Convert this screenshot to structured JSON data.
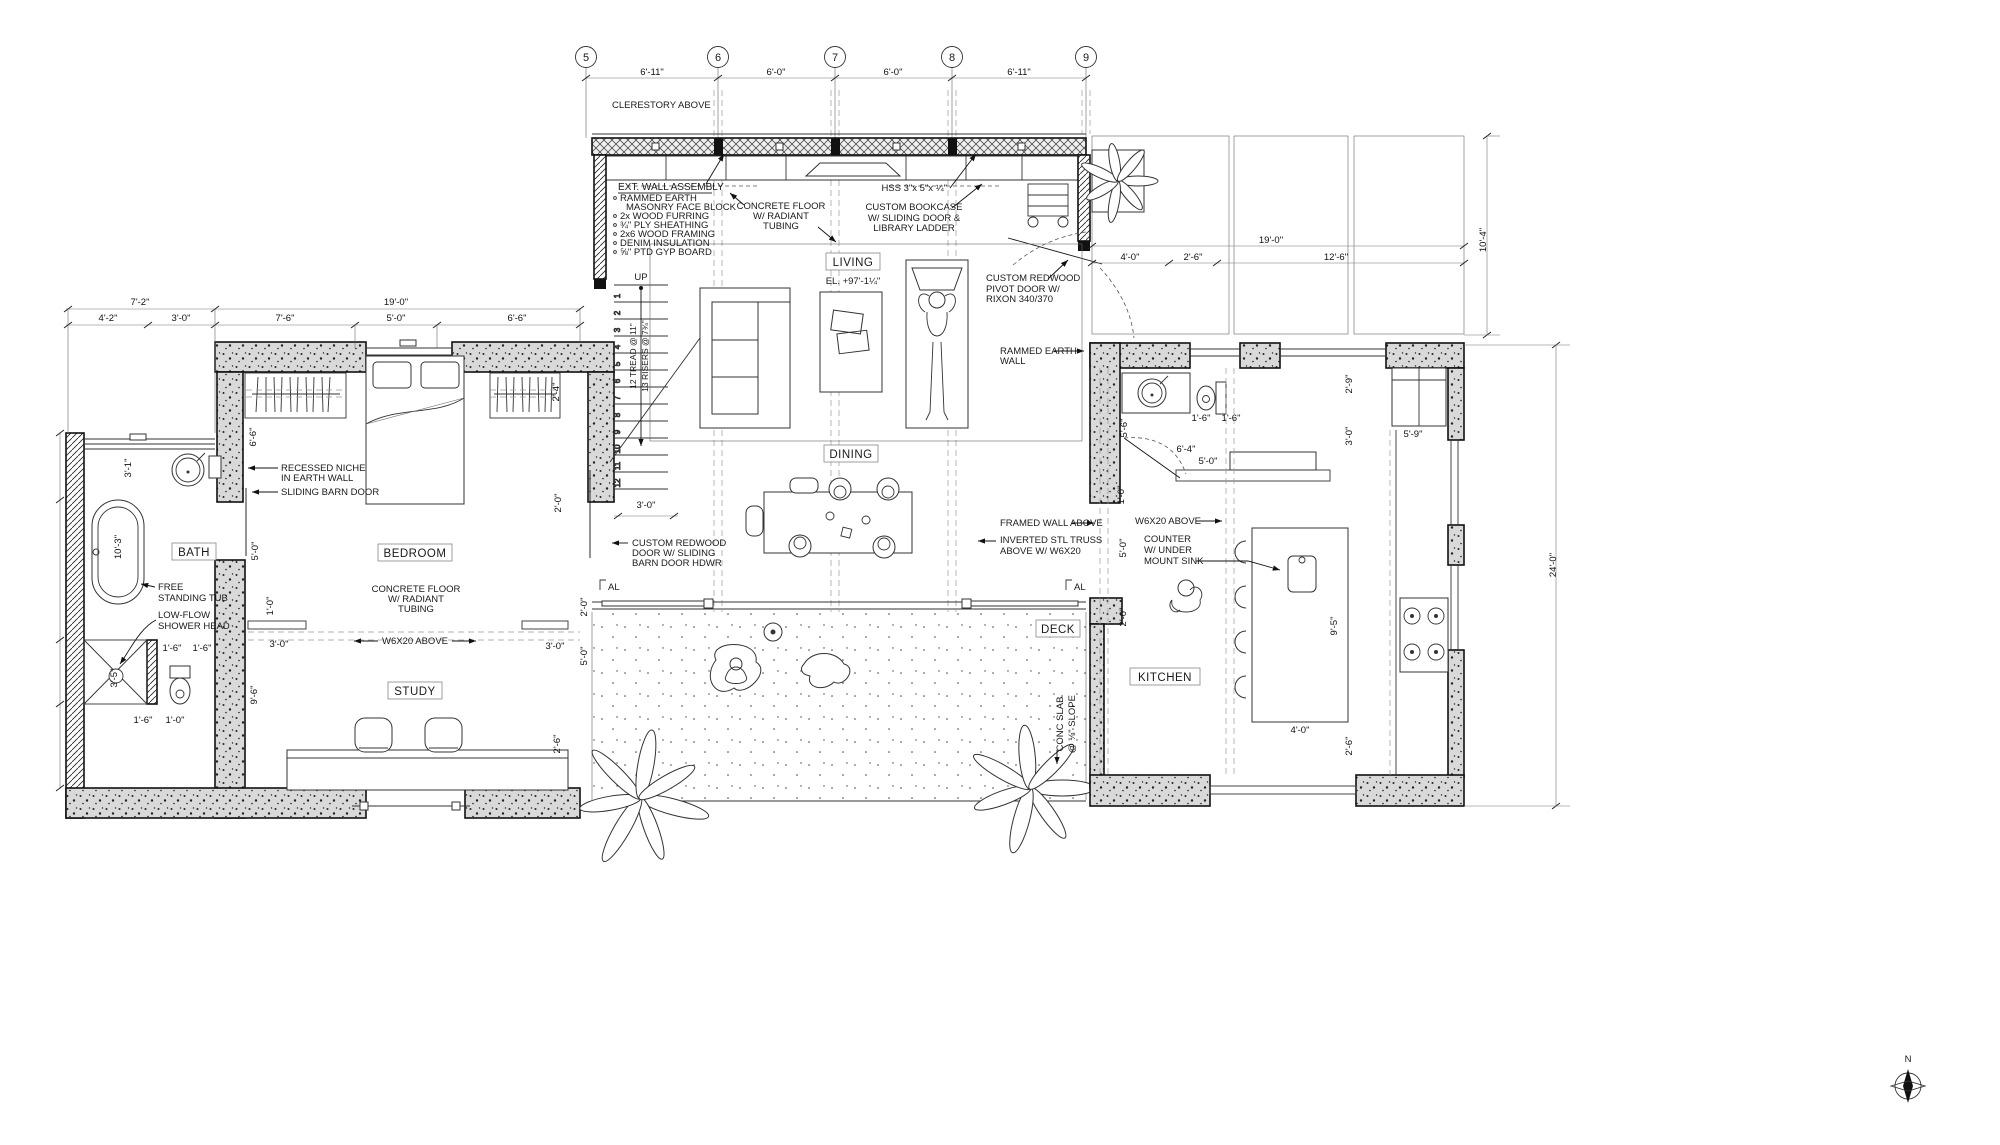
{
  "drawing": {
    "grid": {
      "bubbles": [
        "5",
        "6",
        "7",
        "8",
        "9"
      ],
      "spacings": [
        "6'-11\"",
        "6'-0\"",
        "6'-0\"",
        "6'-11\""
      ]
    },
    "rooms": {
      "living": {
        "name": "LIVING",
        "elevation": "EL. +97'-1¼\""
      },
      "dining": {
        "name": "DINING"
      },
      "deck": {
        "name": "DECK"
      },
      "bath": {
        "name": "BATH"
      },
      "bedroom": {
        "name": "BEDROOM"
      },
      "study": {
        "name": "STUDY"
      },
      "kitchen": {
        "name": "KITCHEN"
      }
    },
    "notes": {
      "clerestory": {
        "lines": [
          "CLERESTORY ABOVE"
        ]
      },
      "wall_assembly": {
        "title": "EXT. WALL ASSEMBLY",
        "items": [
          "RAMMED EARTH",
          "MASONRY FACE BLOCK",
          "2x WOOD FURRING",
          "¾\" PLY SHEATHING",
          "2x6 WOOD FRAMING",
          "DENIM INSULATION",
          "⅝\" PTD GYP BOARD"
        ]
      },
      "concrete_floor_living": {
        "lines": [
          "CONCRETE FLOOR",
          "W/ RADIANT",
          "TUBING"
        ]
      },
      "hss": {
        "lines": [
          "HSS 3\"x 5\"x ¼\""
        ]
      },
      "bookcase": {
        "lines": [
          "CUSTOM BOOKCASE",
          "W/ SLIDING DOOR &",
          "LIBRARY LADDER"
        ]
      },
      "pivot_door": {
        "lines": [
          "CUSTOM REDWOOD",
          "PIVOT DOOR W/",
          "RIXON 340/370"
        ]
      },
      "rammed_earth_wall": {
        "lines": [
          "RAMMED EARTH",
          "WALL"
        ]
      },
      "concrete_floor_bedroom": {
        "lines": [
          "CONCRETE FLOOR",
          "W/ RADIANT",
          "TUBING"
        ]
      },
      "recessed_niche": {
        "lines": [
          "RECESSED NICHE",
          "IN EARTH WALL"
        ]
      },
      "sliding_barn_door": {
        "lines": [
          "SLIDING BARN DOOR"
        ]
      },
      "free_standing_tub": {
        "lines": [
          "FREE",
          "STANDING TUB"
        ]
      },
      "low_flow_shower": {
        "lines": [
          "LOW-FLOW",
          "SHOWER HEAD"
        ]
      },
      "w6x20_study": {
        "lines": [
          "W6X20 ABOVE"
        ]
      },
      "w6x20_kitchen": {
        "lines": [
          "W6X20 ABOVE"
        ]
      },
      "framed_wall": {
        "lines": [
          "FRAMED WALL ABOVE"
        ]
      },
      "inverted_truss": {
        "lines": [
          "INVERTED STL TRUSS",
          "ABOVE W/ W6X20"
        ]
      },
      "counter_sink": {
        "lines": [
          "COUNTER",
          "W/ UNDER",
          "MOUNT SINK"
        ]
      },
      "custom_redwood_door": {
        "lines": [
          "CUSTOM REDWOOD",
          "DOOR W/ SLIDING",
          "BARN DOOR HDWR"
        ]
      },
      "conc_slab": {
        "lines": [
          "CONC SLAB",
          "@ ⅛\" SLOPE"
        ]
      }
    },
    "stair": {
      "direction": "UP",
      "treads": "12 TREAD @ 11\"",
      "risers": "13 RISERS @ 7¾\"",
      "numbers": [
        "1",
        "2",
        "3",
        "4",
        "5",
        "6",
        "7",
        "8",
        "9",
        "10",
        "11",
        "12"
      ]
    },
    "door_tag": "AL",
    "compass_label": "N",
    "dimensions": [
      {
        "t": "6'-11\"",
        "x": 652,
        "y": 75
      },
      {
        "t": "6'-0\"",
        "x": 776,
        "y": 75
      },
      {
        "t": "6'-0\"",
        "x": 893,
        "y": 75
      },
      {
        "t": "6'-11\"",
        "x": 1019,
        "y": 75
      },
      {
        "t": "7'-2\"",
        "x": 140,
        "y": 305
      },
      {
        "t": "19'-0\"",
        "x": 396,
        "y": 305
      },
      {
        "t": "4'-2\"",
        "x": 108,
        "y": 321
      },
      {
        "t": "3'-0\"",
        "x": 181,
        "y": 321
      },
      {
        "t": "7'-6\"",
        "x": 285,
        "y": 321
      },
      {
        "t": "5'-0\"",
        "x": 396,
        "y": 321
      },
      {
        "t": "6'-6\"",
        "x": 517,
        "y": 321
      },
      {
        "t": "3'-1\"",
        "x": 131,
        "y": 468,
        "r": -90
      },
      {
        "t": "10'-3\"",
        "x": 121,
        "y": 547,
        "r": -90
      },
      {
        "t": "3'-5\"",
        "x": 117,
        "y": 678,
        "r": -90
      },
      {
        "t": "6'-6\"",
        "x": 256,
        "y": 437,
        "r": -90
      },
      {
        "t": "5'-0\"",
        "x": 258,
        "y": 551,
        "r": -90
      },
      {
        "t": "1'-0\"",
        "x": 273,
        "y": 606,
        "r": -90
      },
      {
        "t": "2'-4\"",
        "x": 559,
        "y": 392,
        "r": -90
      },
      {
        "t": "2'-0\"",
        "x": 561,
        "y": 503,
        "r": -90
      },
      {
        "t": "3'-0\"",
        "x": 279,
        "y": 647
      },
      {
        "t": "1'-6\"",
        "x": 172,
        "y": 651
      },
      {
        "t": "1'-6\"",
        "x": 202,
        "y": 651
      },
      {
        "t": "9'-6\"",
        "x": 257,
        "y": 695,
        "r": -90
      },
      {
        "t": "3'-0\"",
        "x": 555,
        "y": 649
      },
      {
        "t": "1'-6\"",
        "x": 143,
        "y": 723
      },
      {
        "t": "1'-0\"",
        "x": 175,
        "y": 723
      },
      {
        "t": "2'-6\"",
        "x": 560,
        "y": 744,
        "r": -90
      },
      {
        "t": "2'-0\"",
        "x": 587,
        "y": 607,
        "r": -90
      },
      {
        "t": "5'-0\"",
        "x": 587,
        "y": 656,
        "r": -90
      },
      {
        "t": "3'-0\"",
        "x": 646,
        "y": 508
      },
      {
        "t": "5'-6\"",
        "x": 1127,
        "y": 428,
        "r": -90
      },
      {
        "t": "1'-6\"",
        "x": 1201,
        "y": 421
      },
      {
        "t": "1'-6\"",
        "x": 1231,
        "y": 421
      },
      {
        "t": "6'-4\"",
        "x": 1186,
        "y": 452
      },
      {
        "t": "5'-0\"",
        "x": 1208,
        "y": 464
      },
      {
        "t": "1'-0\"",
        "x": 1124,
        "y": 495,
        "r": -90
      },
      {
        "t": "5'-0\"",
        "x": 1126,
        "y": 548,
        "r": -90
      },
      {
        "t": "2'-0\"",
        "x": 1126,
        "y": 617,
        "r": -90
      },
      {
        "t": "2'-9\"",
        "x": 1352,
        "y": 384,
        "r": -90
      },
      {
        "t": "3'-0\"",
        "x": 1352,
        "y": 436,
        "r": -90
      },
      {
        "t": "5'-9\"",
        "x": 1413,
        "y": 437
      },
      {
        "t": "9'-5\"",
        "x": 1337,
        "y": 626,
        "r": -90
      },
      {
        "t": "4'-0\"",
        "x": 1300,
        "y": 733
      },
      {
        "t": "2'-6\"",
        "x": 1352,
        "y": 746,
        "r": -90
      },
      {
        "t": "19'-0\"",
        "x": 1271,
        "y": 243
      },
      {
        "t": "4'-0\"",
        "x": 1130,
        "y": 260
      },
      {
        "t": "2'-6\"",
        "x": 1193,
        "y": 260
      },
      {
        "t": "12'-6\"",
        "x": 1336,
        "y": 260
      },
      {
        "t": "10'-4\"",
        "x": 1486,
        "y": 240,
        "r": -90
      },
      {
        "t": "24'-0\"",
        "x": 1556,
        "y": 565,
        "r": -90
      }
    ]
  }
}
